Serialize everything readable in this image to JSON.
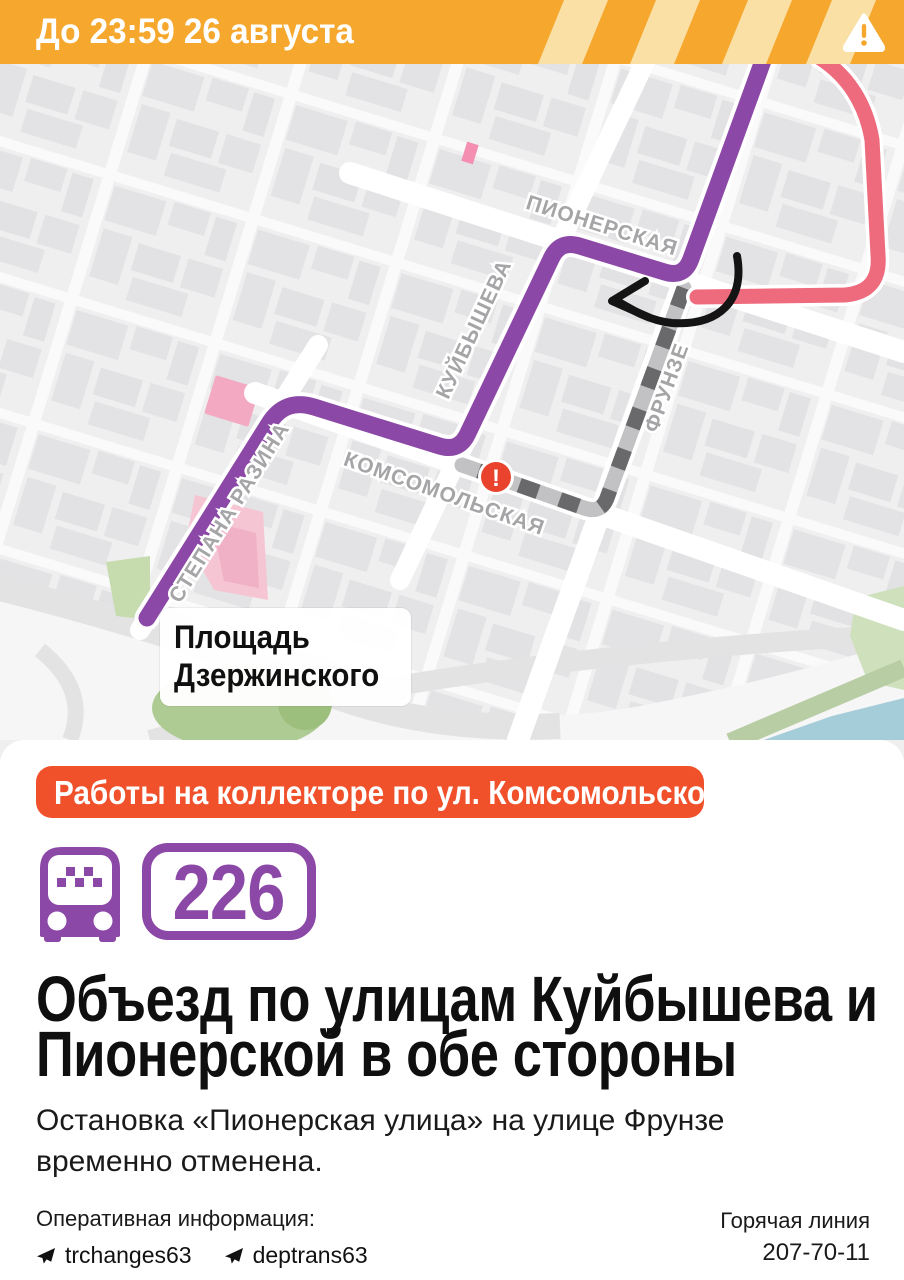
{
  "banner": {
    "text": "До 23:59 26 августа"
  },
  "map": {
    "street_labels": {
      "pionerskaya": "ПИОНЕРСКАЯ",
      "kuibysheva": "КУЙБЫШЕВА",
      "frunze": "ФРУНЗЕ",
      "komsomolskaya": "КОМСОМОЛЬСКАЯ",
      "stepana_razina": "СТЕПАНА РАЗИНА"
    },
    "place_label_line1": "Площадь",
    "place_label_line2": "Дзержинского",
    "closure_marker": "!"
  },
  "card": {
    "badge_text": "Работы на коллекторе по ул. Комсомольской",
    "route_number": "226",
    "title_line1": "Объезд по улицам Куйбышева и",
    "title_line2": "Пионерской в обе стороны",
    "body_line1": "Остановка «Пионерская улица» на улице Фрунзе",
    "body_line2": "временно отменена.",
    "footer": {
      "info_label": "Оперативная информация:",
      "channel1": "trchanges63",
      "channel2": "deptrans63",
      "hotline_label": "Горячая линия",
      "hotline_number": "207-70-11"
    }
  },
  "colors": {
    "banner_orange": "#F6A72E",
    "banner_stripe": "#FBE0A6",
    "alert_orange": "#F0512B",
    "route_purple": "#8C48A6",
    "route_red": "#EE6B7D",
    "closed_road_dark": "#69686B",
    "marker_red": "#E9432E",
    "map_background": "#F0EFEF"
  }
}
